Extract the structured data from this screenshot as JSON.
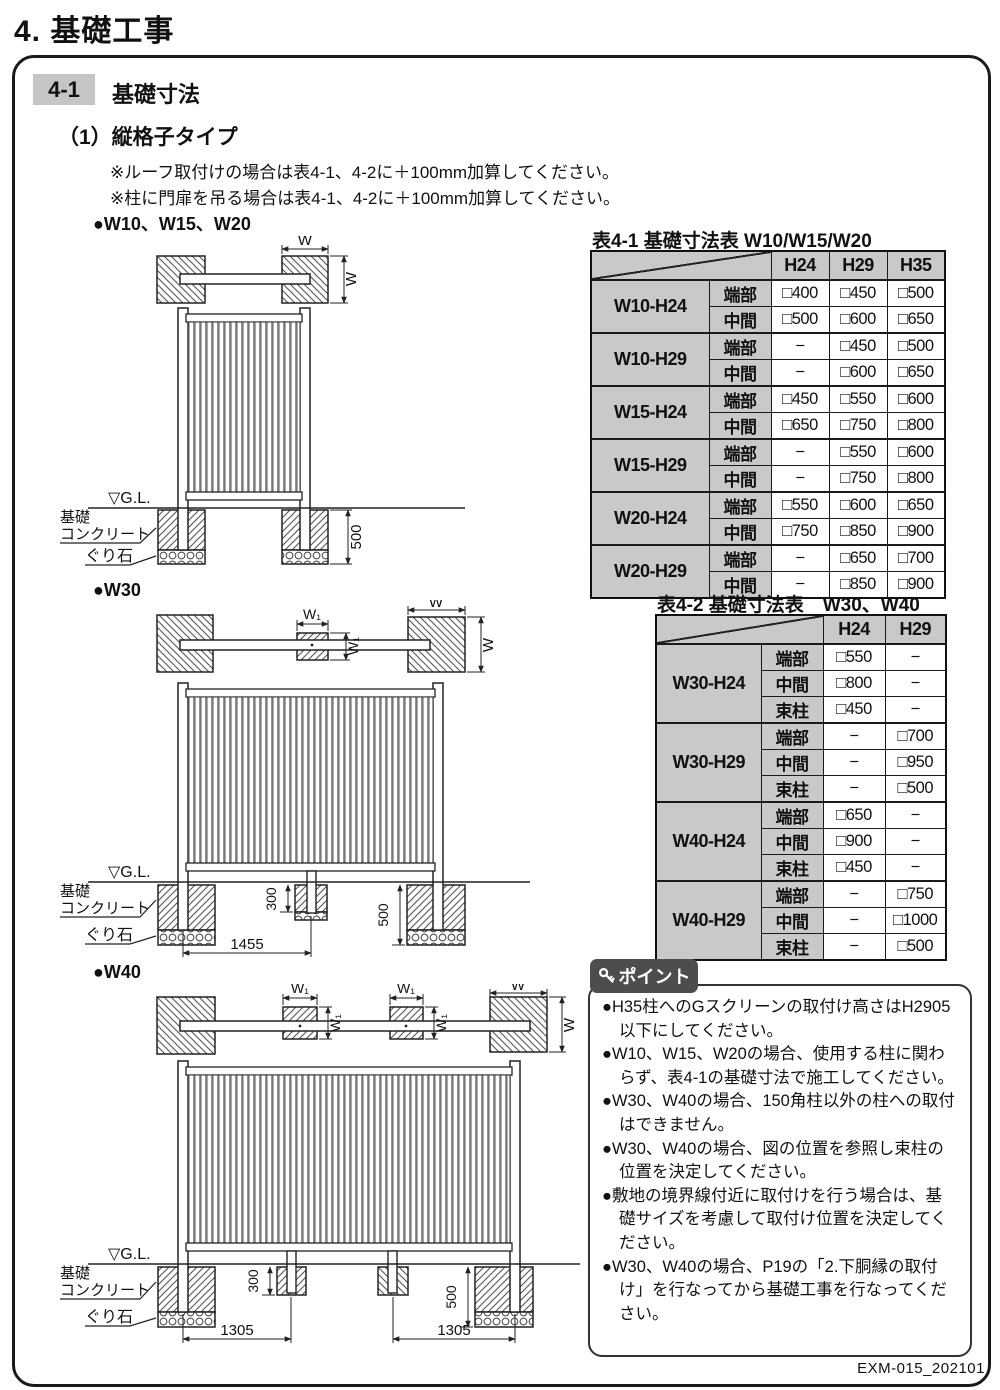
{
  "page": {
    "title": "4. 基礎工事",
    "footer": "EXM-015_202101"
  },
  "section": {
    "badge": "4-1",
    "title": "基礎寸法",
    "subtitle": "（1）縦格子タイプ",
    "notes": [
      "※ルーフ取付けの場合は表4-1、4-2に＋100mm加算してください。",
      "※柱に門扉を吊る場合は表4-1、4-2に＋100mm加算してください。"
    ]
  },
  "diagrams": {
    "labels": {
      "d1": "●W10、W15、W20",
      "d2": "●W30",
      "d3": "●W40"
    },
    "common": {
      "gl": "▽G.L.",
      "concrete_line1": "基礎",
      "concrete_line2": "コンクリート",
      "stone": "ぐり石",
      "w": "W",
      "w1": "W₁"
    },
    "d1": {
      "depth": "500"
    },
    "d2": {
      "stub_depth": "300",
      "depth": "500",
      "span": "1455"
    },
    "d3": {
      "stub_depth": "300",
      "depth": "500",
      "span": "1305"
    }
  },
  "table1": {
    "title": "表4-1 基礎寸法表  W10/W15/W20",
    "columns": [
      "H24",
      "H29",
      "H35"
    ],
    "row_labels": [
      "端部",
      "中間"
    ],
    "groups": [
      {
        "name": "W10-H24",
        "rows": [
          [
            "□400",
            "□450",
            "□500"
          ],
          [
            "□500",
            "□600",
            "□650"
          ]
        ]
      },
      {
        "name": "W10-H29",
        "rows": [
          [
            "−",
            "□450",
            "□500"
          ],
          [
            "−",
            "□600",
            "□650"
          ]
        ]
      },
      {
        "name": "W15-H24",
        "rows": [
          [
            "□450",
            "□550",
            "□600"
          ],
          [
            "□650",
            "□750",
            "□800"
          ]
        ]
      },
      {
        "name": "W15-H29",
        "rows": [
          [
            "−",
            "□550",
            "□600"
          ],
          [
            "−",
            "□750",
            "□800"
          ]
        ]
      },
      {
        "name": "W20-H24",
        "rows": [
          [
            "□550",
            "□600",
            "□650"
          ],
          [
            "□750",
            "□850",
            "□900"
          ]
        ]
      },
      {
        "name": "W20-H29",
        "rows": [
          [
            "−",
            "□650",
            "□700"
          ],
          [
            "−",
            "□850",
            "□900"
          ]
        ]
      }
    ]
  },
  "table2": {
    "title": "表4-2 基礎寸法表　W30、W40",
    "columns": [
      "H24",
      "H29"
    ],
    "row_labels": [
      "端部",
      "中間",
      "束柱"
    ],
    "groups": [
      {
        "name": "W30-H24",
        "rows": [
          [
            "□550",
            "−"
          ],
          [
            "□800",
            "−"
          ],
          [
            "□450",
            "−"
          ]
        ]
      },
      {
        "name": "W30-H29",
        "rows": [
          [
            "−",
            "□700"
          ],
          [
            "−",
            "□950"
          ],
          [
            "−",
            "□500"
          ]
        ]
      },
      {
        "name": "W40-H24",
        "rows": [
          [
            "□650",
            "−"
          ],
          [
            "□900",
            "−"
          ],
          [
            "□450",
            "−"
          ]
        ]
      },
      {
        "name": "W40-H29",
        "rows": [
          [
            "−",
            "□750"
          ],
          [
            "−",
            "□1000"
          ],
          [
            "−",
            "□500"
          ]
        ]
      }
    ]
  },
  "points": {
    "badge": "ポイント",
    "items": [
      "●H35柱へのGスクリーンの取付け高さはH2905以下にしてください。",
      "●W10、W15、W20の場合、使用する柱に関わらず、表4-1の基礎寸法で施工してください。",
      "●W30、W40の場合、150角柱以外の柱への取付はできません。",
      "●W30、W40の場合、図の位置を参照し束柱の位置を決定してください。",
      "●敷地の境界線付近に取付けを行う場合は、基礎サイズを考慮して取付け位置を決定してください。",
      "●W30、W40の場合、P19の「2.下胴縁の取付け」を行なってから基礎工事を行なってください。"
    ]
  },
  "colors": {
    "header_gray": "#c9c9c9",
    "badge_gray": "#c5c5c5",
    "point_dark": "#4d4d4d"
  }
}
